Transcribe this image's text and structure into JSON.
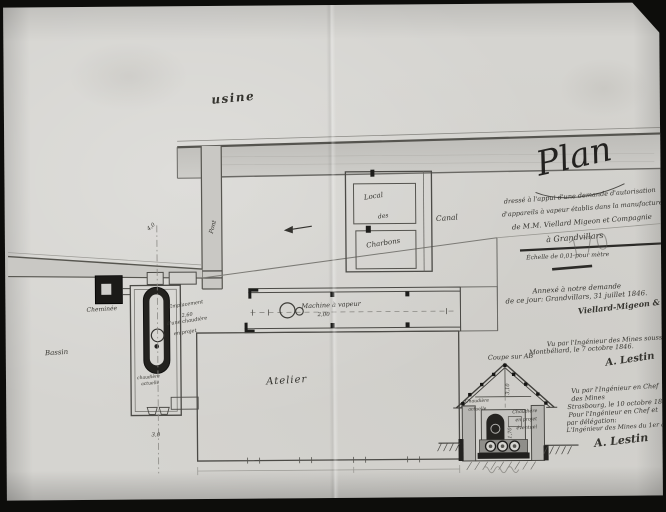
{
  "colors": {
    "paper": "#d5d4d0",
    "ink": "#3a3935",
    "wash": "#c7c6c2"
  },
  "plan": {
    "usine": "usine",
    "pont": "Pont",
    "canal": "Canal",
    "bassin": "Bassin",
    "cheminee": "Cheminée",
    "atelier": "Atelier",
    "machine": "Machine à vapeur",
    "machine_dim": "2,00",
    "local_lines": [
      "Local",
      "des",
      "Charbons"
    ],
    "chaudiere_lines": [
      "chaudière",
      "actuelle"
    ],
    "emplacement_lines": [
      "Emplacement",
      "2,60",
      "d'une chaudière",
      "en projet"
    ],
    "dim_axis_top": "4,0",
    "dim_axis_bottom": "3,0"
  },
  "title_block": {
    "title": "Plan",
    "subtitle_lines": [
      "dressé à l'appui d'une demande d'autorisation",
      "d'appareils à vapeur établis dans la manufacture",
      "de M.M. Viellard Migeon et Compagnie",
      "à Grandvillars"
    ],
    "scale": "Échelle de 0,01 pour mètre",
    "pencil_note": "170"
  },
  "approvals": {
    "request_lines": [
      "Annexé à notre demande",
      "de ce jour: Grandvillars, 31 juillet 1846.",
      "Viellard-Migeon & Cie"
    ],
    "engineer_lines": [
      "Vu par l'Ingénieur des Mines soussigné",
      "Montbéliard, le 7 octobre 1846.",
      "A. Lestin"
    ],
    "chief_lines": [
      "Vu par l'Ingénieur en Chef",
      "des Mines",
      "Strasbourg, le 10 octobre 1846.",
      "Pour l'Ingénieur en Chef et",
      "par délégation:",
      "L'Ingénieur des Mines du 1er arrondt",
      "A. Lestin"
    ]
  },
  "section": {
    "title": "Coupe sur AB",
    "left_lines": [
      "Chaudière",
      "actuelle"
    ],
    "right_lines": [
      "Chaudière",
      "en projet",
      "éventuel"
    ],
    "dim_height": "3,10",
    "dim_width": "1,70"
  }
}
